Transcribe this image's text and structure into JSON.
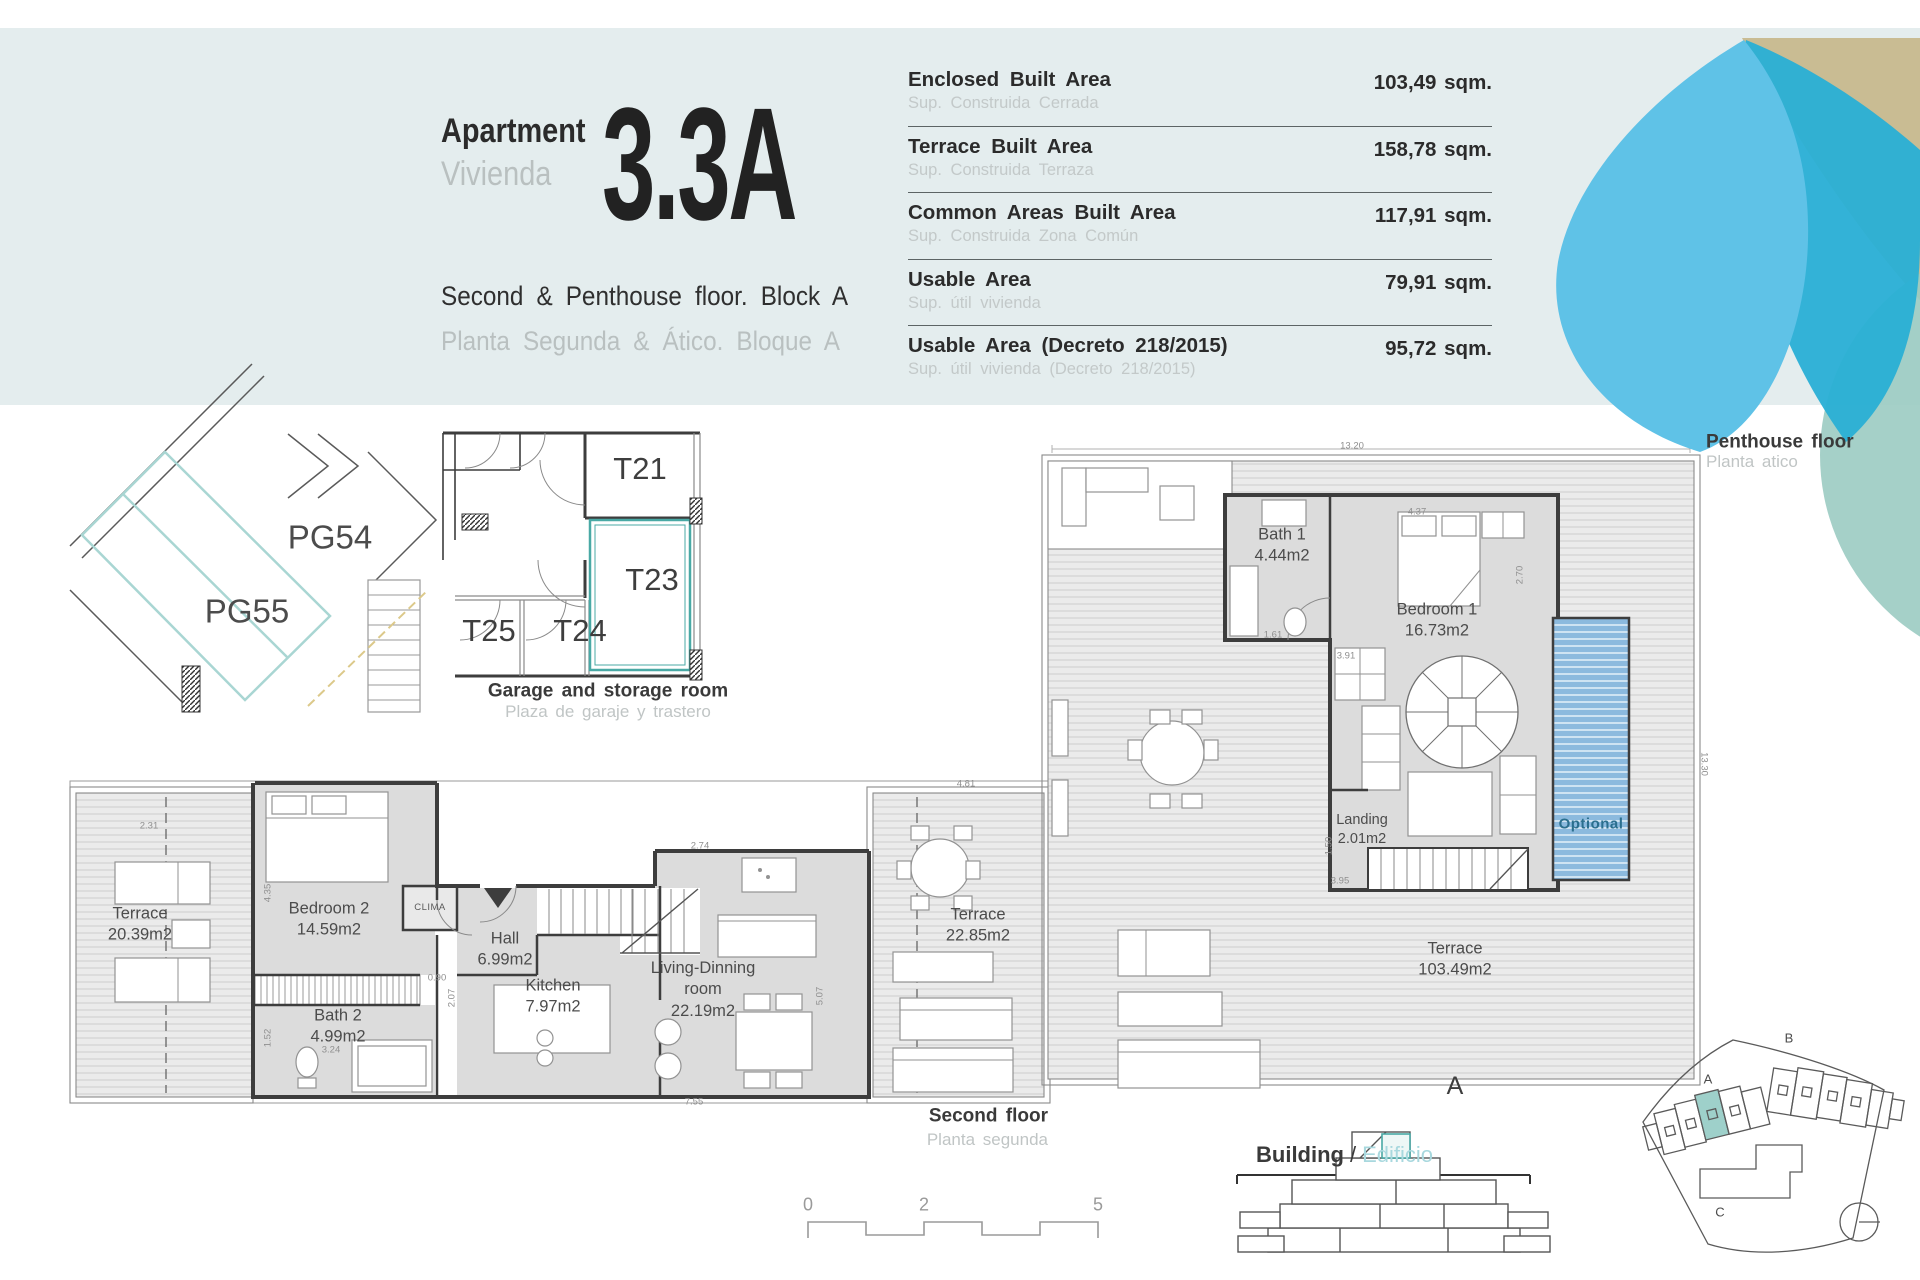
{
  "header": {
    "apartment_en": "Apartment",
    "apartment_es": "Vivienda",
    "unit": "3.3A",
    "floor_en": "Second & Penthouse floor. Block A",
    "floor_es": "Planta Segunda & Ático. Bloque A",
    "areas": [
      {
        "en": "Enclosed Built Area",
        "es": "Sup. Construida Cerrada",
        "value": "103,49 sqm."
      },
      {
        "en": "Terrace Built Area",
        "es": "Sup. Construida Terraza",
        "value": "158,78 sqm."
      },
      {
        "en": "Common Areas Built Area",
        "es": "Sup. Construida Zona Común",
        "value": "117,91 sqm."
      },
      {
        "en": "Usable Area",
        "es": "Sup. útil vivienda",
        "value": "79,91 sqm."
      },
      {
        "en": "Usable Area (Decreto 218/2015)",
        "es": "Sup. útil vivienda (Decreto 218/2015)",
        "value": "95,72 sqm."
      }
    ]
  },
  "garage": {
    "pg54": "PG54",
    "pg55": "PG55",
    "t21": "T21",
    "t23": "T23",
    "t24": "T24",
    "t25": "T25",
    "caption_en": "Garage and storage room",
    "caption_es": "Plaza de garaje y trastero"
  },
  "second_floor": {
    "caption_en": "Second floor",
    "caption_es": "Planta segunda",
    "terrace_left_name": "Terrace",
    "terrace_left_area": "20.39m2",
    "bedroom2_name": "Bedroom 2",
    "bedroom2_area": "14.59m2",
    "clima": "CLIMA",
    "hall_name": "Hall",
    "hall_area": "6.99m2",
    "kitchen_name": "Kitchen",
    "kitchen_area": "7.97m2",
    "bath2_name": "Bath 2",
    "bath2_area": "4.99m2",
    "living_name_1": "Living-Dinning",
    "living_name_2": "room",
    "living_area": "22.19m2",
    "terrace_right_name": "Terrace",
    "terrace_right_area": "22.85m2"
  },
  "penthouse": {
    "caption_en": "Penthouse floor",
    "caption_es": "Planta atico",
    "bath1_name": "Bath 1",
    "bath1_area": "4.44m2",
    "bedroom1_name": "Bedroom 1",
    "bedroom1_area": "16.73m2",
    "landing_name": "Landing",
    "landing_area": "2.01m2",
    "optional": "Optional",
    "terrace_name": "Terrace",
    "terrace_area": "103.49m2",
    "block_letter": "A"
  },
  "building": {
    "en": "Building",
    "slash": "/",
    "es": "Edificio"
  },
  "site": {
    "a": "A",
    "b": "B",
    "c": "C"
  },
  "scale": {
    "t0": "0",
    "t1": "2",
    "t2": "5"
  },
  "colors": {
    "accent_teal": "#49a9a5",
    "logo_blue": "#5fc2e7",
    "logo_cyan": "#29afd5",
    "logo_tan": "#c9bc93",
    "logo_sage": "#9bcbc2",
    "pool_blue": "#8cbade",
    "panel": "#e4edee"
  },
  "dims": [
    {
      "t": "2.31",
      "x": 149,
      "y": 826
    },
    {
      "t": "4.35",
      "x": 268,
      "y": 893,
      "r": -90
    },
    {
      "t": "1.52",
      "x": 268,
      "y": 1038,
      "r": -90
    },
    {
      "t": "0.90",
      "x": 437,
      "y": 978
    },
    {
      "t": "2.07",
      "x": 452,
      "y": 998,
      "r": -90
    },
    {
      "t": "3.24",
      "x": 331,
      "y": 1050
    },
    {
      "t": "2.74",
      "x": 700,
      "y": 846
    },
    {
      "t": "4.81",
      "x": 966,
      "y": 784
    },
    {
      "t": "5.07",
      "x": 820,
      "y": 996,
      "r": -90
    },
    {
      "t": "7.55",
      "x": 694,
      "y": 1102
    },
    {
      "t": "13.20",
      "x": 1352,
      "y": 446
    },
    {
      "t": "13.30",
      "x": 1704,
      "y": 764,
      "r": 90
    },
    {
      "t": "4.37",
      "x": 1417,
      "y": 512
    },
    {
      "t": "2.70",
      "x": 1520,
      "y": 575,
      "r": -90
    },
    {
      "t": "3.91",
      "x": 1346,
      "y": 656
    },
    {
      "t": "1.61",
      "x": 1273,
      "y": 635
    },
    {
      "t": "1.50",
      "x": 1329,
      "y": 846,
      "r": -90
    },
    {
      "t": "3.95",
      "x": 1340,
      "y": 881
    }
  ]
}
